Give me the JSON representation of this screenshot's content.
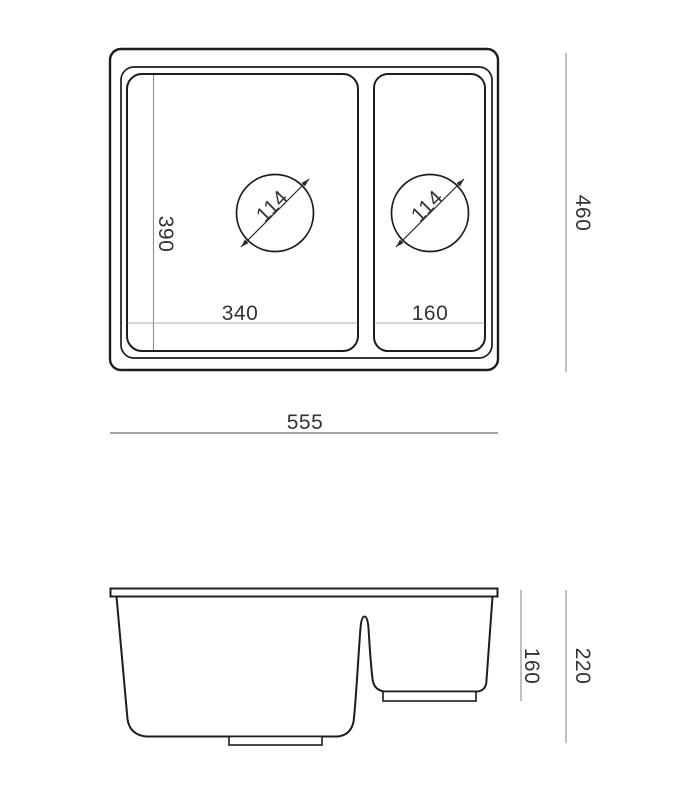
{
  "drawing_type": "sink-technical-drawing",
  "colors": {
    "background": "#ffffff",
    "outline": "#1d1d1d",
    "dimension_line": "#8c8c8c",
    "text": "#333333"
  },
  "top_view": {
    "overall_width": "555",
    "overall_depth": "460",
    "main_bowl_length": "390",
    "main_bowl_width": "340",
    "half_bowl_width": "160",
    "main_drain_diameter": "114",
    "half_drain_diameter": "114"
  },
  "side_view": {
    "half_bowl_depth": "160",
    "overall_height": "220"
  }
}
